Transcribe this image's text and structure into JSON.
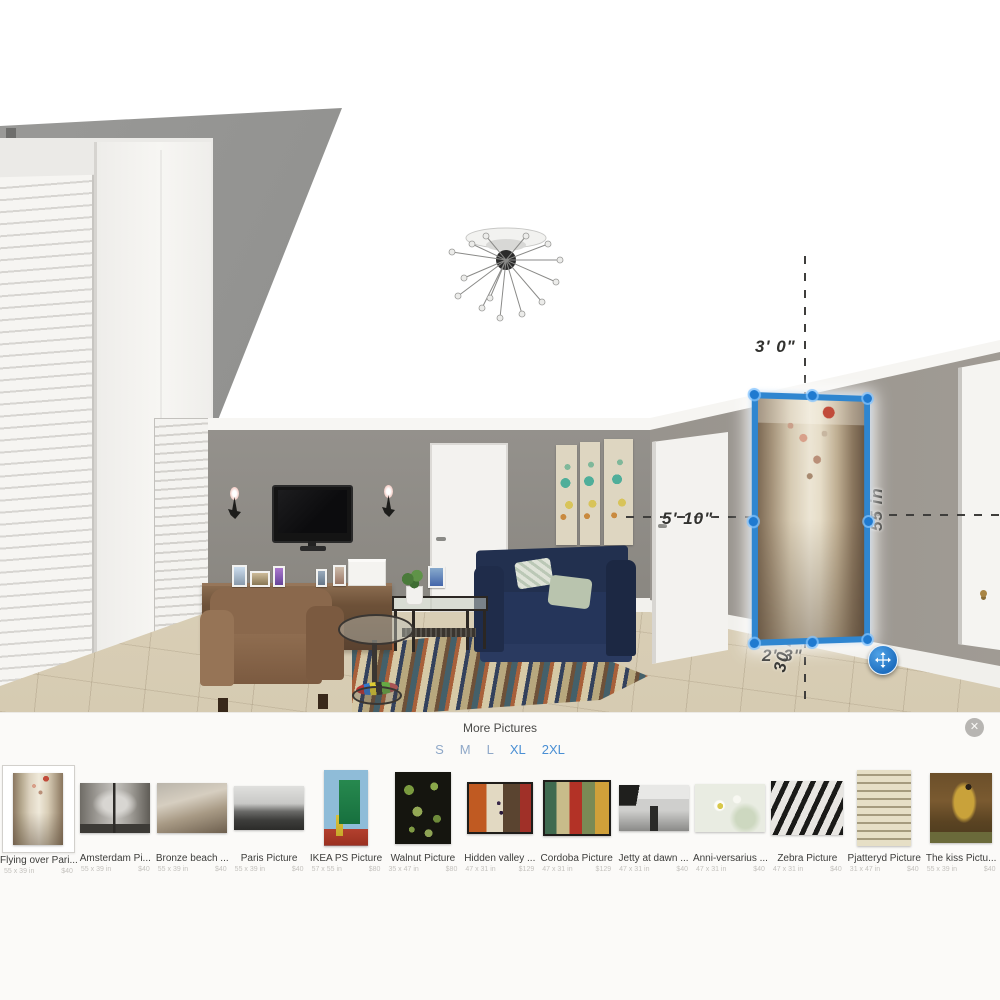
{
  "window": {
    "close_icon": "✕"
  },
  "panel": {
    "title": "More Pictures",
    "sizes": [
      "S",
      "M",
      "L",
      "XL",
      "2XL"
    ]
  },
  "measurements": {
    "distance_above": "3' 0\"",
    "distance_left": "5' 10\"",
    "picture_height": "55 in",
    "distance_below": "2' 3\"",
    "picture_width": "30 in"
  },
  "colors": {
    "selection_accent": "#2f86d0",
    "size_link_blue": "#4a8fd4"
  },
  "items": [
    {
      "name": "Flying over Pari...",
      "dims": "55 x 39 in",
      "price": "$40"
    },
    {
      "name": "Amsterdam Pi...",
      "dims": "55 x 39 in",
      "price": "$40"
    },
    {
      "name": "Bronze beach ...",
      "dims": "55 x 39 in",
      "price": "$40"
    },
    {
      "name": "Paris Picture",
      "dims": "55 x 39 in",
      "price": "$40"
    },
    {
      "name": "IKEA PS Picture",
      "dims": "57 x 55 in",
      "price": "$80"
    },
    {
      "name": "Walnut Picture",
      "dims": "35 x 47 in",
      "price": "$80"
    },
    {
      "name": "Hidden valley ...",
      "dims": "47 x 31 in",
      "price": "$129"
    },
    {
      "name": "Cordoba Picture",
      "dims": "47 x 31 in",
      "price": "$129"
    },
    {
      "name": "Jetty at dawn ...",
      "dims": "47 x 31 in",
      "price": "$40"
    },
    {
      "name": "Anni-versarius ...",
      "dims": "47 x 31 in",
      "price": "$40"
    },
    {
      "name": "Zebra Picture",
      "dims": "47 x 31 in",
      "price": "$40"
    },
    {
      "name": "Pjatteryd Picture",
      "dims": "31 x 47 in",
      "price": "$40"
    },
    {
      "name": "The kiss Pictu...",
      "dims": "55 x 39 in",
      "price": "$40"
    }
  ]
}
